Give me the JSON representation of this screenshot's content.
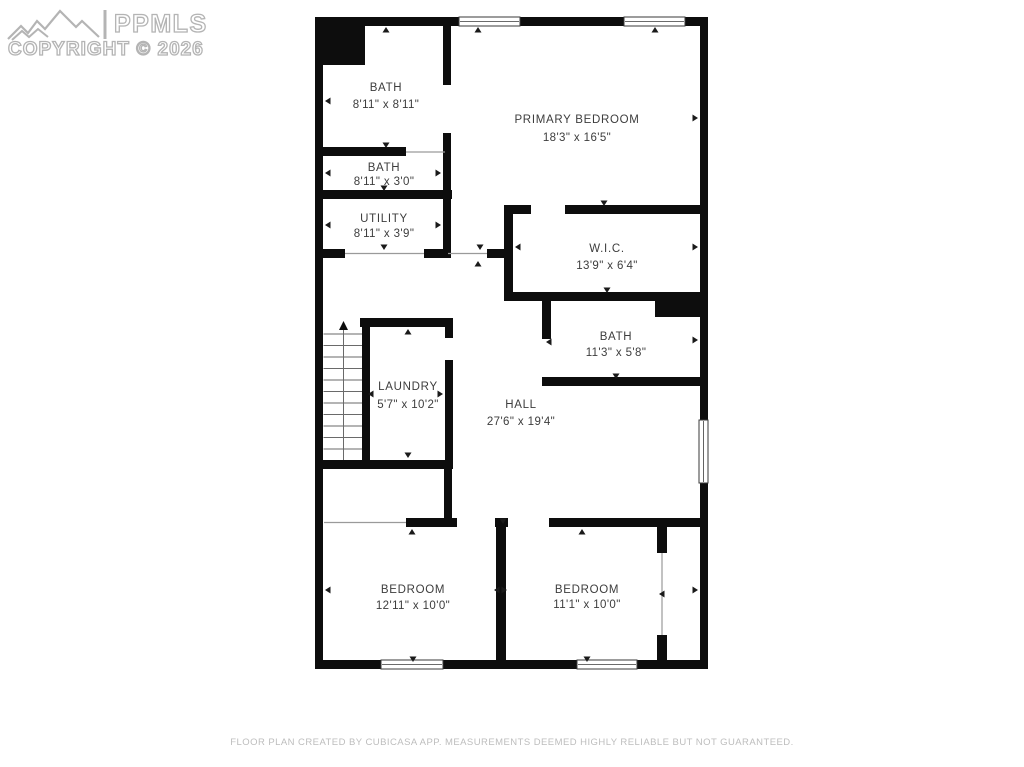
{
  "watermark": {
    "brand": "PPMLS",
    "copyright": "COPYRIGHT © 2026"
  },
  "rooms": [
    {
      "name": "BATH",
      "dimensions": "8'11\" x 8'11\""
    },
    {
      "name": "BATH",
      "dimensions": "8'11\" x 3'0\""
    },
    {
      "name": "UTILITY",
      "dimensions": "8'11\" x 3'9\""
    },
    {
      "name": "PRIMARY BEDROOM",
      "dimensions": "18'3\" x 16'5\""
    },
    {
      "name": "W.I.C.",
      "dimensions": "13'9\" x 6'4\""
    },
    {
      "name": "BATH",
      "dimensions": "11'3\" x 5'8\""
    },
    {
      "name": "LAUNDRY",
      "dimensions": "5'7\" x 10'2\""
    },
    {
      "name": "HALL",
      "dimensions": "27'6\" x 19'4\""
    },
    {
      "name": "BEDROOM",
      "dimensions": "12'11\" x 10'0\""
    },
    {
      "name": "BEDROOM",
      "dimensions": "11'1\" x 10'0\""
    }
  ],
  "footer": {
    "disclaimer": "FLOOR PLAN CREATED BY CUBICASA APP. MEASUREMENTS DEEMED HIGHLY RELIABLE BUT NOT GUARANTEED."
  },
  "colors": {
    "wall": "#0d0d0d",
    "room_label": "#3d3d3d",
    "watermark_outline": "#b4b4b4",
    "disclaimer_text": "#bdbdbd"
  }
}
